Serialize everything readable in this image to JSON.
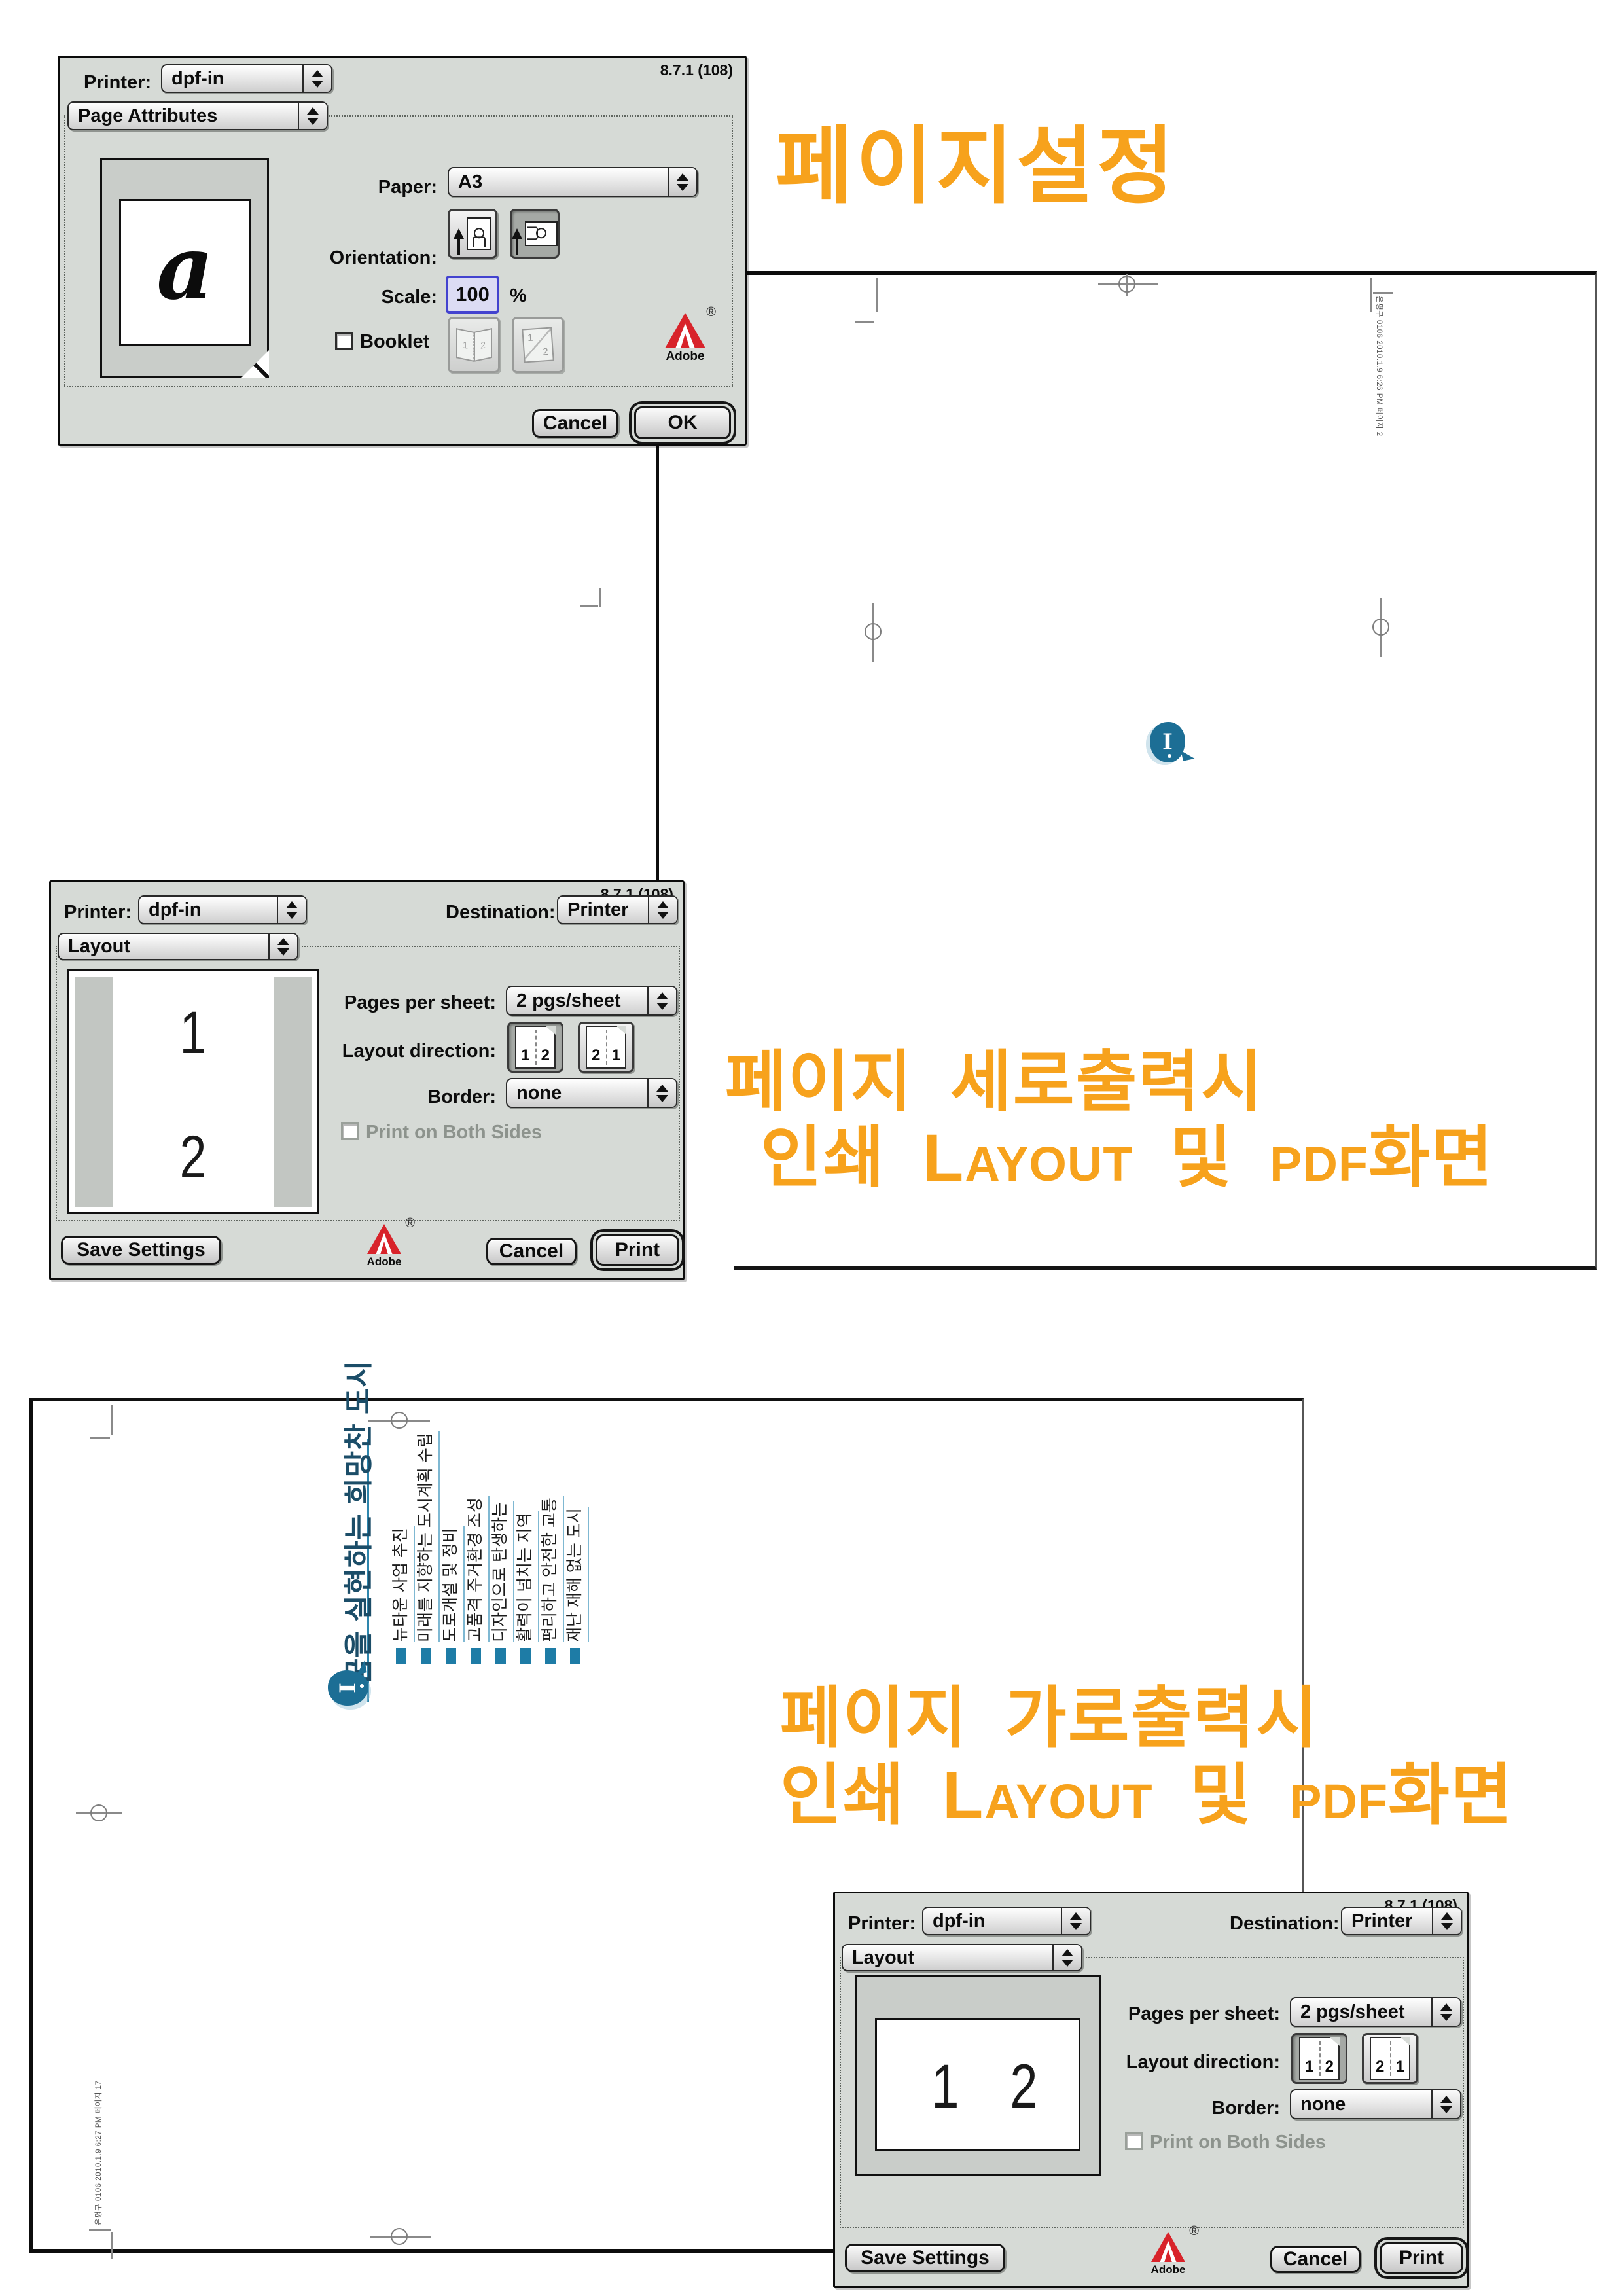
{
  "annotations": {
    "heading1": "페이지설정",
    "portrait_line1": "페이지 세로출력시",
    "landscape_line1": "페이지 가로출력시",
    "line2_prefix": "인쇄",
    "line2_layout_cap": "L",
    "line2_layout_rest": "AYOUT",
    "line2_mid": "및",
    "line2_pdf": "PDF",
    "line2_suffix": "화면",
    "accent_color": "#F7A21C"
  },
  "page_setup": {
    "version": "8.7.1 (108)",
    "printer_label": "Printer:",
    "printer_value": "dpf-in",
    "section_value": "Page Attributes",
    "preview_letter": "a",
    "paper_label": "Paper:",
    "paper_value": "A3",
    "orientation_label": "Orientation:",
    "scale_label": "Scale:",
    "scale_value": "100",
    "scale_unit": "%",
    "booklet_label": "Booklet",
    "adobe_label": "Adobe",
    "adobe_reg": "®",
    "cancel_label": "Cancel",
    "ok_label": "OK"
  },
  "print_portrait": {
    "version": "8.7.1 (108)",
    "printer_label": "Printer:",
    "printer_value": "dpf-in",
    "destination_label": "Destination:",
    "destination_value": "Printer",
    "section_value": "Layout",
    "pages_per_sheet_label": "Pages per sheet:",
    "pages_per_sheet_value": "2 pgs/sheet",
    "layout_direction_label": "Layout direction:",
    "dir1": [
      "1",
      "2"
    ],
    "dir2": [
      "2",
      "1"
    ],
    "border_label": "Border:",
    "border_value": "none",
    "both_sides_label": "Print on Both Sides",
    "save_label": "Save Settings",
    "adobe_label": "Adobe",
    "adobe_reg": "®",
    "cancel_label": "Cancel",
    "print_label": "Print",
    "preview_page1": "1",
    "preview_page2": "2"
  },
  "print_landscape": {
    "version": "8.7.1 (108)",
    "printer_label": "Printer:",
    "printer_value": "dpf-in",
    "destination_label": "Destination:",
    "destination_value": "Printer",
    "section_value": "Layout",
    "pages_per_sheet_label": "Pages per sheet:",
    "pages_per_sheet_value": "2 pgs/sheet",
    "layout_direction_label": "Layout direction:",
    "dir1": [
      "1",
      "2"
    ],
    "dir2": [
      "2",
      "1"
    ],
    "border_label": "Border:",
    "border_value": "none",
    "both_sides_label": "Print on Both Sides",
    "save_label": "Save Settings",
    "adobe_label": "Adobe",
    "adobe_reg": "®",
    "cancel_label": "Cancel",
    "print_label": "Print",
    "preview_page1": "1",
    "preview_page2": "2"
  },
  "pdf_portrait": {
    "slug": "은평구 0106  2010.1.9 6:26 PM  페이지 2",
    "logo_letter": "I"
  },
  "pdf_landscape": {
    "logo_letter": "I",
    "title": "꿈을 실현하는 희망찬 도시",
    "items": [
      "뉴타운 사업 추진",
      "미래를 지향하는 도시계획 수립",
      "도로개설 및 정비",
      "고품격 주거환경 조성",
      "디자인으로 탄생하는",
      "활력이 넘치는 지역",
      "편리하고 안전한 교통",
      "재난 재해 없는 도시"
    ],
    "slug": "은평구 0106  2010.1.9 6:27 PM  페이지 17"
  },
  "icons": {
    "popup_stepper": "up-down triangles",
    "registration_mark": "circle-cross",
    "adobe_logo": "red A triangle"
  }
}
